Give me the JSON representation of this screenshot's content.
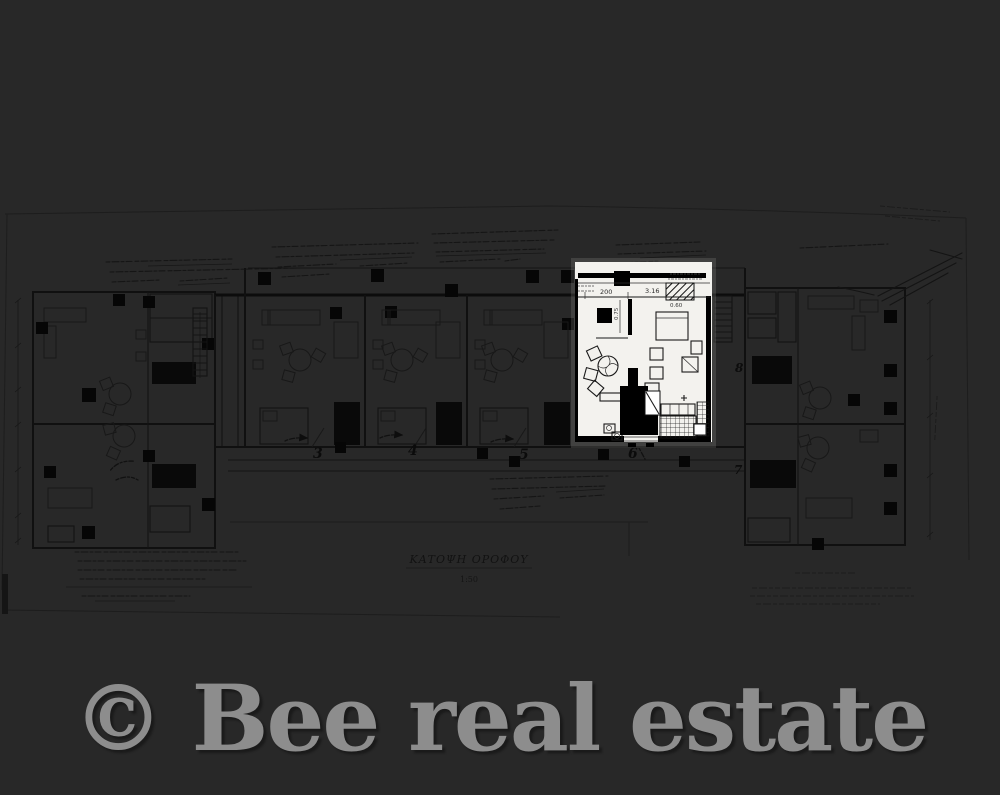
{
  "watermark": {
    "text": "© Bee real estate",
    "color": "#8d8d8d"
  },
  "floor_plan": {
    "kind": "apartment-building-floor-plan",
    "colors": {
      "background": "#282828",
      "plan_ink": "#101010",
      "highlight_background": "#f3f2ee",
      "watermark_gray": "#8d8d8d"
    },
    "unit_numbers": {
      "unit3": "3",
      "unit4": "4",
      "unit5": "5",
      "unit6": "6",
      "unit7": "7",
      "unit8": "8"
    },
    "highlighted_unit": {
      "number": "6",
      "dims": {
        "d200": "200",
        "d316": "3.16",
        "d060": "0.60",
        "d075": "0.75"
      }
    },
    "title_block": {
      "title": "ΚΑΤΟΨΗ ΟΡΟΦΟΥ",
      "scale": "1:50"
    }
  }
}
